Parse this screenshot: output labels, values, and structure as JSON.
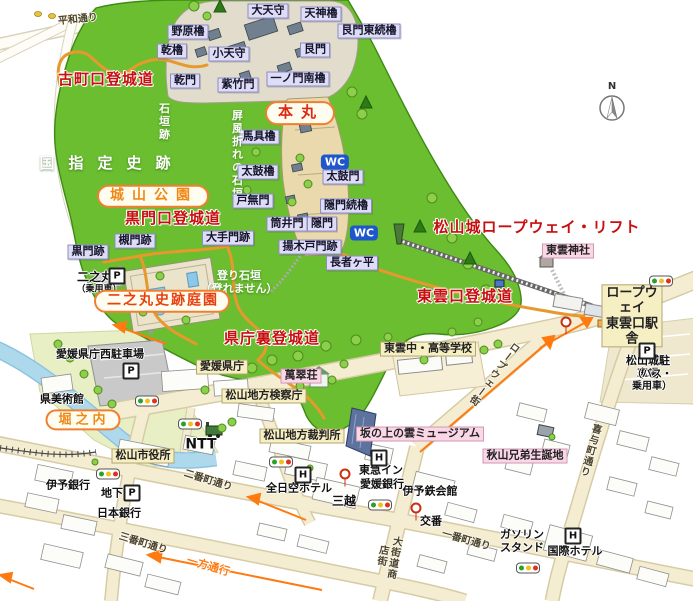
{
  "glyphs": {
    "wc": "WC",
    "parking": "P",
    "hotel": "H",
    "north": "N"
  },
  "colors": {
    "hill_green": "#6abe2f",
    "road_fill": "#f4edd2",
    "road_casing": "#d6cba4",
    "moat_blue": "#aed9ec",
    "route_red": "#c80f0f",
    "pill_border": "#f08030",
    "castle_label_bg": "#dedcf6",
    "public_label_bg": "#f7efc4",
    "sight_label_bg": "#fad6e6",
    "trail_orange": "#e6992e",
    "oneway_arrow": "#ff7a10",
    "wc_blue": "#1e56cc"
  },
  "labels": [
    {
      "name": "road-label-heiwa-dori",
      "text": "平和通り",
      "x": 78,
      "y": 20,
      "type": "road",
      "rot": -6
    },
    {
      "name": "route-komachiguchi-tojodo",
      "text": "古町口登城道",
      "x": 106,
      "y": 80,
      "type": "route"
    },
    {
      "name": "castle-nohara-yagura",
      "text": "野原櫓",
      "x": 188,
      "y": 32,
      "type": "box"
    },
    {
      "name": "castle-inui-yagura",
      "text": "乾櫓",
      "x": 172,
      "y": 51,
      "type": "box"
    },
    {
      "name": "castle-daitenshu",
      "text": "大天守",
      "x": 268,
      "y": 11,
      "type": "box"
    },
    {
      "name": "castle-tenjin-yagura",
      "text": "天神櫓",
      "x": 321,
      "y": 14,
      "type": "box"
    },
    {
      "name": "castle-ushitoramon-higashi-tsuzuki-yagura",
      "text": "艮門東続櫓",
      "x": 369,
      "y": 31,
      "type": "box"
    },
    {
      "name": "castle-kotenshu",
      "text": "小天守",
      "x": 229,
      "y": 54,
      "type": "box"
    },
    {
      "name": "castle-ushitoramon",
      "text": "艮門",
      "x": 315,
      "y": 50,
      "type": "box"
    },
    {
      "name": "castle-inuimon",
      "text": "乾門",
      "x": 185,
      "y": 81,
      "type": "box"
    },
    {
      "name": "castle-shichikumon",
      "text": "紫竹門",
      "x": 238,
      "y": 85,
      "type": "box"
    },
    {
      "name": "castle-ichinomon-minami-yagura",
      "text": "一ノ門南櫓",
      "x": 298,
      "y": 79,
      "type": "box"
    },
    {
      "name": "area-honmaru",
      "text": "本丸",
      "x": 300,
      "y": 113,
      "type": "pill",
      "color": "#e02810",
      "fs": 15,
      "ls": 8
    },
    {
      "name": "castle-bagu-yagura",
      "text": "馬具櫓",
      "x": 259,
      "y": 137,
      "type": "box"
    },
    {
      "name": "label-ishigaki-ato",
      "text": "石垣跡",
      "x": 163,
      "y": 122,
      "type": "vwhite"
    },
    {
      "name": "label-byobuore-no-ishigaki",
      "text": "屏風折れの石垣",
      "x": 236,
      "y": 155,
      "type": "vwhite"
    },
    {
      "name": "label-kuni-shitei-shiseki",
      "text": "国指定史跡",
      "x": 112,
      "y": 164,
      "type": "white",
      "fs": 15,
      "ls": 14
    },
    {
      "name": "castle-taiko-yagura",
      "text": "太鼓櫓",
      "x": 258,
      "y": 172,
      "type": "box"
    },
    {
      "name": "castle-taikomon",
      "text": "太鼓門",
      "x": 343,
      "y": 177,
      "type": "box"
    },
    {
      "name": "area-shiroyama-koen",
      "text": "城山公園",
      "x": 153,
      "y": 196,
      "type": "pill",
      "color": "#f08818",
      "fs": 14,
      "ls": 8
    },
    {
      "name": "castle-tonashimon",
      "text": "戸無門",
      "x": 253,
      "y": 201,
      "type": "box"
    },
    {
      "name": "castle-kakuremon-tsuzuki-yagura",
      "text": "隠門続櫓",
      "x": 346,
      "y": 206,
      "type": "box"
    },
    {
      "name": "route-kuromonguchi-tojodo",
      "text": "黒門口登城道",
      "x": 173,
      "y": 219,
      "type": "route"
    },
    {
      "name": "castle-tsutsuimon",
      "text": "筒井門",
      "x": 287,
      "y": 224,
      "type": "box"
    },
    {
      "name": "castle-kakuremon",
      "text": "隠門",
      "x": 322,
      "y": 224,
      "type": "box"
    },
    {
      "name": "castle-otemon-ato",
      "text": "大手門跡",
      "x": 228,
      "y": 238,
      "type": "box"
    },
    {
      "name": "route-matsuyamajo-ropeway-lift",
      "text": "松山城ロープウェイ・リフト",
      "x": 537,
      "y": 228,
      "type": "route"
    },
    {
      "name": "castle-tsukimon-ato",
      "text": "槻門跡",
      "x": 135,
      "y": 241,
      "type": "box"
    },
    {
      "name": "castle-kuromon-ato",
      "text": "黒門跡",
      "x": 88,
      "y": 252,
      "type": "box"
    },
    {
      "name": "castle-agekidomon-ato",
      "text": "揚木戸門跡",
      "x": 310,
      "y": 247,
      "type": "box"
    },
    {
      "name": "label-chojagadaira",
      "text": "長者ヶ平",
      "x": 352,
      "y": 263,
      "type": "box"
    },
    {
      "name": "label-shinonome-jinja",
      "text": "東雲神社",
      "x": 568,
      "y": 251,
      "type": "pink"
    },
    {
      "name": "label-ninomaru",
      "text": "二之丸",
      "x": 95,
      "y": 277,
      "type": "plain",
      "fs": 12
    },
    {
      "name": "label-ninomaru-car-note",
      "text": "（乗用車）",
      "x": 99,
      "y": 290,
      "type": "plain",
      "fs": 9
    },
    {
      "name": "label-nobori-ishigaki",
      "text": "登り石垣\n（登れません）",
      "x": 239,
      "y": 283,
      "type": "white",
      "fs": 11
    },
    {
      "name": "route-shinonomeguchi-tojodo",
      "text": "東雲口登城道",
      "x": 465,
      "y": 297,
      "type": "route"
    },
    {
      "name": "area-ninomaru-shiseki-teien",
      "text": "二之丸史跡庭園",
      "x": 162,
      "y": 301,
      "type": "pill",
      "color": "#e84010",
      "fs": 14,
      "ls": 2
    },
    {
      "name": "label-ropeway-shinonomeguchi-station",
      "text": "ロープウェイ\n東雲口駅舎",
      "x": 632,
      "y": 316,
      "type": "cream",
      "fs": 13
    },
    {
      "name": "route-kencho-ura-tojodo",
      "text": "県庁裏登城道",
      "x": 272,
      "y": 339,
      "type": "route"
    },
    {
      "name": "label-shinonome-school",
      "text": "東雲中・高等学校",
      "x": 428,
      "y": 349,
      "type": "cream"
    },
    {
      "name": "label-kencho-nishi-parking",
      "text": "愛媛県庁西駐車場",
      "x": 100,
      "y": 355,
      "type": "plain"
    },
    {
      "name": "label-ehime-kencho",
      "text": "愛媛県庁",
      "x": 222,
      "y": 367,
      "type": "cream"
    },
    {
      "name": "label-matsuyamajo-parking",
      "text": "松山城駐車場",
      "x": 648,
      "y": 368,
      "type": "plain"
    },
    {
      "name": "label-matsuyamajo-parking-note",
      "text": "（バス・乗用車）",
      "x": 652,
      "y": 381,
      "type": "plain",
      "fs": 10
    },
    {
      "name": "label-bansuiso",
      "text": "萬翠荘",
      "x": 301,
      "y": 376,
      "type": "pink"
    },
    {
      "name": "label-ken-bijutsukan",
      "text": "県美術館",
      "x": 62,
      "y": 400,
      "type": "plain"
    },
    {
      "name": "label-matsuyama-kensatsucho",
      "text": "松山地方検察庁",
      "x": 264,
      "y": 396,
      "type": "cream"
    },
    {
      "name": "area-horinouchi",
      "text": "堀之内",
      "x": 83,
      "y": 420,
      "type": "pill",
      "color": "#f08818",
      "fs": 13,
      "ls": 4
    },
    {
      "name": "label-matsuyama-saibansho",
      "text": "松山地方裁判所",
      "x": 302,
      "y": 436,
      "type": "cream"
    },
    {
      "name": "label-sakanoue-no-kumo-museum",
      "text": "坂の上の雲ミュージアム",
      "x": 420,
      "y": 434,
      "type": "pink"
    },
    {
      "name": "road-label-kiyocho-dori",
      "text": "喜与町通り",
      "x": 589,
      "y": 450,
      "type": "vroad",
      "rot": 15
    },
    {
      "name": "label-akiyama-kyodai-birthplace",
      "text": "秋山兄弟生誕地",
      "x": 525,
      "y": 456,
      "type": "pink"
    },
    {
      "name": "label-ntt",
      "text": "NTT",
      "x": 201,
      "y": 445,
      "type": "plain",
      "fs": 14
    },
    {
      "name": "label-matsuyama-shiyakusho",
      "text": "松山市役所",
      "x": 143,
      "y": 456,
      "type": "cream"
    },
    {
      "name": "label-iyo-ginko",
      "text": "伊予銀行",
      "x": 68,
      "y": 486,
      "type": "plain"
    },
    {
      "name": "label-chika",
      "text": "地下",
      "x": 112,
      "y": 494,
      "type": "plain"
    },
    {
      "name": "label-nippon-ginko",
      "text": "日本銀行",
      "x": 119,
      "y": 514,
      "type": "plain"
    },
    {
      "name": "road-label-nibancho-dori",
      "text": "二番町通り",
      "x": 208,
      "y": 481,
      "type": "road",
      "rot": 17
    },
    {
      "name": "label-zennikku-hotel",
      "text": "全日空ホテル",
      "x": 299,
      "y": 489,
      "type": "plain"
    },
    {
      "name": "label-mitsukoshi",
      "text": "三越",
      "x": 344,
      "y": 501,
      "type": "plain",
      "fs": 12
    },
    {
      "name": "label-tokyu-inn",
      "text": "東急イン",
      "x": 381,
      "y": 471,
      "type": "plain"
    },
    {
      "name": "label-ehime-ginko",
      "text": "愛媛銀行",
      "x": 382,
      "y": 485,
      "type": "plain"
    },
    {
      "name": "label-iyotetsu-kaikan",
      "text": "伊予鉄会館",
      "x": 430,
      "y": 492,
      "type": "plain"
    },
    {
      "name": "label-koban",
      "text": "交番",
      "x": 431,
      "y": 522,
      "type": "plain"
    },
    {
      "name": "road-label-okaido-shotengai",
      "text": "大街道商店街",
      "x": 387,
      "y": 556,
      "type": "vroad",
      "rot": 10
    },
    {
      "name": "road-label-ichibancho-dori",
      "text": "一番町通り",
      "x": 466,
      "y": 541,
      "type": "road",
      "rot": 16
    },
    {
      "name": "label-gasoline-stand",
      "text": "ガソリン\nスタンド",
      "x": 522,
      "y": 542,
      "type": "plain"
    },
    {
      "name": "label-kokusai-hotel",
      "text": "国際ホテル",
      "x": 575,
      "y": 552,
      "type": "plain"
    },
    {
      "name": "road-label-sanbancho-dori",
      "text": "三番町通り",
      "x": 143,
      "y": 544,
      "type": "road",
      "rot": 17
    },
    {
      "name": "label-ippo-tsuko",
      "text": "一方通行",
      "x": 208,
      "y": 567,
      "type": "oneway",
      "rot": 16
    },
    {
      "name": "road-label-ropeway-gai",
      "text": "ロープウェー街",
      "x": 493,
      "y": 373,
      "type": "vroad",
      "rot": 37
    }
  ],
  "icons": {
    "wc": [
      {
        "x": 335,
        "y": 162
      },
      {
        "x": 364,
        "y": 233
      }
    ],
    "parking": [
      {
        "x": 117,
        "y": 276
      },
      {
        "x": 131,
        "y": 371
      },
      {
        "x": 132,
        "y": 493
      },
      {
        "x": 647,
        "y": 351
      }
    ],
    "hotel": [
      {
        "x": 303,
        "y": 475
      },
      {
        "x": 379,
        "y": 458
      },
      {
        "x": 573,
        "y": 536
      }
    ],
    "traffic_lights": [
      {
        "x": 147,
        "y": 401
      },
      {
        "x": 190,
        "y": 424
      },
      {
        "x": 108,
        "y": 474
      },
      {
        "x": 281,
        "y": 462
      },
      {
        "x": 380,
        "y": 505
      },
      {
        "x": 528,
        "y": 568
      },
      {
        "x": 661,
        "y": 281
      }
    ],
    "stops": [
      {
        "x": 345,
        "y": 474
      },
      {
        "x": 416,
        "y": 508
      },
      {
        "x": 566,
        "y": 322
      }
    ]
  }
}
